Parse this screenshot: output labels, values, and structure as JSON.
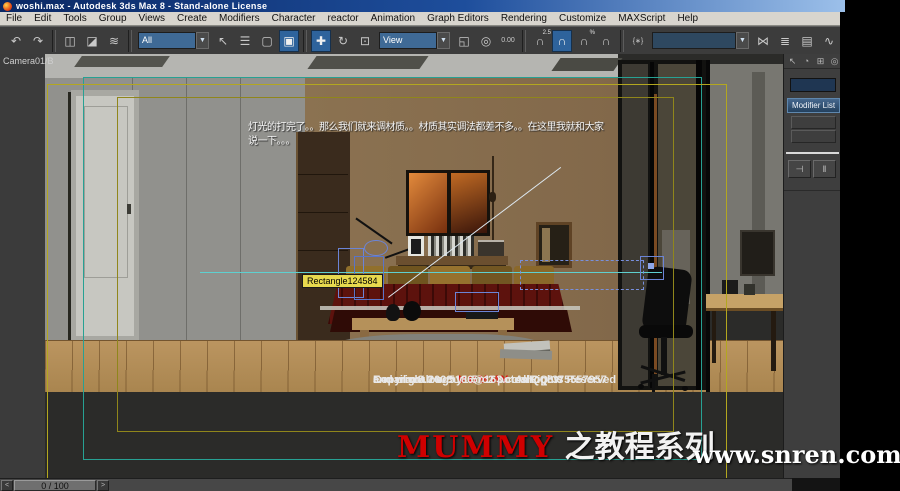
{
  "window": {
    "title": "woshi.max - Autodesk 3ds Max 8  - Stand-alone License"
  },
  "menu_bar": {
    "items": [
      "File",
      "Edit",
      "Tools",
      "Group",
      "Views",
      "Create",
      "Modifiers",
      "Character",
      "reactor",
      "Animation",
      "Graph Editors",
      "Rendering",
      "Customize",
      "MAXScript",
      "Help"
    ]
  },
  "toolbar": {
    "items": [
      {
        "kind": "icon",
        "name": "undo",
        "glyph": "↶"
      },
      {
        "kind": "icon",
        "name": "redo",
        "glyph": "↷"
      },
      {
        "kind": "sep"
      },
      {
        "kind": "icon",
        "name": "select-and-link",
        "glyph": "◫"
      },
      {
        "kind": "icon",
        "name": "unlink-selection",
        "glyph": "◪"
      },
      {
        "kind": "icon",
        "name": "bind-to-space-warp",
        "glyph": "≋"
      },
      {
        "kind": "sep"
      },
      {
        "kind": "dropdown",
        "name": "selection-filter",
        "value": "All"
      },
      {
        "kind": "icon",
        "name": "select-object",
        "glyph": "↖"
      },
      {
        "kind": "icon",
        "name": "select-by-name",
        "glyph": "☰"
      },
      {
        "kind": "icon",
        "name": "rect-selection-region",
        "glyph": "▢"
      },
      {
        "kind": "icon",
        "name": "window-crossing-toggle",
        "glyph": "▣",
        "active": true
      },
      {
        "kind": "sep"
      },
      {
        "kind": "icon",
        "name": "select-and-move",
        "glyph": "✚",
        "active": true
      },
      {
        "kind": "icon",
        "name": "select-and-rotate",
        "glyph": "↻"
      },
      {
        "kind": "icon",
        "name": "select-and-uniform-scale",
        "glyph": "⊡"
      },
      {
        "kind": "dropdown",
        "name": "reference-coordinate-system",
        "value": "View"
      },
      {
        "kind": "icon",
        "name": "use-pivot-point-center",
        "glyph": "◱"
      },
      {
        "kind": "icon",
        "name": "select-and-manipulate",
        "glyph": "◎"
      },
      {
        "kind": "icon",
        "name": "keyboard-shortcut-override",
        "glyph": "0.00",
        "text_icon": true
      },
      {
        "kind": "sep"
      },
      {
        "kind": "icon",
        "name": "snaps-toggle",
        "glyph": "∩",
        "sup": "2.5"
      },
      {
        "kind": "icon",
        "name": "angle-snap-toggle",
        "glyph": "∩",
        "active": true
      },
      {
        "kind": "icon",
        "name": "percent-snap-toggle",
        "glyph": "∩",
        "sup": "%"
      },
      {
        "kind": "icon",
        "name": "spinner-snap-toggle",
        "glyph": "∩"
      },
      {
        "kind": "sep"
      },
      {
        "kind": "icon",
        "name": "edit-named-selection-sets",
        "glyph": "{∗}",
        "text_icon": true
      },
      {
        "kind": "dropdown",
        "name": "named-selection-sets",
        "value": "",
        "wide": true
      },
      {
        "kind": "icon",
        "name": "mirror",
        "glyph": "⋈"
      },
      {
        "kind": "icon",
        "name": "align",
        "glyph": "≣"
      },
      {
        "kind": "icon",
        "name": "layer-manager",
        "glyph": "▤"
      },
      {
        "kind": "icon",
        "name": "curve-editor",
        "glyph": "∿"
      },
      {
        "kind": "icon",
        "name": "schematic-view",
        "glyph": "⊞"
      },
      {
        "kind": "sep"
      },
      {
        "kind": "icon",
        "name": "material-editor",
        "glyph": "◔"
      },
      {
        "kind": "icon",
        "name": "render-scene",
        "glyph": "▦"
      },
      {
        "kind": "icon",
        "name": "quick-render",
        "glyph": "◑"
      }
    ]
  },
  "viewport": {
    "label": "Camera01/B",
    "note_line1": "灯光的打完了。。那么我们就来调材质。。材质其实调法都差不多。。在这里我就和大家",
    "note_line2": "说一下。。。",
    "tooltip": "Rectangle124584"
  },
  "overlay": {
    "copyright_prefix": "Copyright 2008",
    "copyright_brand": "MUMMY",
    "copyright_suffix": "AllRights Reserved",
    "credit_line": "and max8.0 v-ray1.5rc2 potoshop8.0",
    "contact_line": "E-mail:malong5186@163.com QQ:375557957",
    "watermark_brand": "MUMMY",
    "watermark_series": "之教程系列",
    "watermark_site": "www.snren.com"
  },
  "command_panel": {
    "tabs": [
      {
        "name": "tab-create",
        "glyph": "↖"
      },
      {
        "name": "tab-modify",
        "glyph": "◔"
      },
      {
        "name": "tab-hierarchy",
        "glyph": "⊞"
      },
      {
        "name": "tab-motion",
        "glyph": "◎"
      }
    ],
    "object_name": "",
    "modifier_list_label": "Modifier List",
    "pin_stack_glyph": "⊣",
    "show_end_result_glyph": "‖"
  },
  "status_bar": {
    "prev": "<",
    "time": "0 / 100",
    "next": ">"
  },
  "colors": {
    "active_tool_blue": "#2e639c",
    "overlay_yellow": "#b3a71f",
    "overlay_teal": "#27a193",
    "selection_wire_blue": "#6b84d6",
    "tooltip_bg": "#e7d94e",
    "brand_red": "#cf0000",
    "title_gradient_start": "#0a2864",
    "title_gradient_end": "#9cc0ea"
  }
}
